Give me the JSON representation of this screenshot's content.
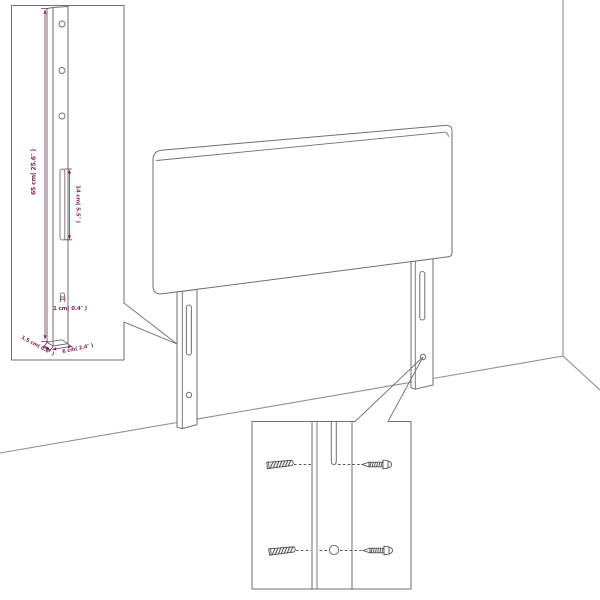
{
  "diagram": {
    "title": "headboard wall-mount assembly diagram",
    "callout_board": {
      "height_label": "65 cm( 25.6″ )",
      "slot_label": "14 cm( 5.5″ )",
      "hole_label": "1 cm( 0.4″ )",
      "thickness_label": "1.5 cm( 0.6″ )",
      "width_label": "6 cm( 2.4″ )"
    },
    "colors": {
      "outline": "#6f6f6f",
      "wall": "#8f8f8f",
      "hardware": "#4f4f4f",
      "dimension": "#7b2a5b",
      "background": "#ffffff"
    }
  }
}
